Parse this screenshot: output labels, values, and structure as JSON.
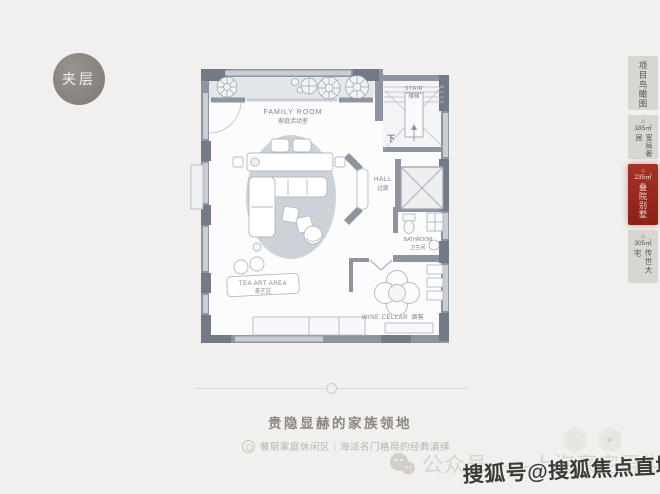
{
  "page": {
    "background": "#f1f0ee"
  },
  "badge": {
    "label": "夹层"
  },
  "floorplan": {
    "rooms": {
      "family": {
        "en": "FAMILY ROOM",
        "zh": "家庭活动室"
      },
      "stair": {
        "en": "STAIR",
        "zh": "楼梯",
        "direction": "下"
      },
      "hall": {
        "en": "HALL",
        "zh": "过廊"
      },
      "bathroom": {
        "en": "BATHROOM",
        "zh": "卫生间"
      },
      "tea": {
        "en": "TEA ART AREA",
        "zh": "茶艺区"
      },
      "wine": {
        "en": "WINE CELLAR",
        "zh": "酒窖"
      }
    }
  },
  "sidebar": {
    "items": [
      {
        "label": "项目鸟瞰图",
        "active": false
      },
      {
        "marker": "⌂",
        "area": "185㎡",
        "label": "宽局奢居",
        "active": false
      },
      {
        "marker": "⌂",
        "area": "235㎡",
        "label": "叠院别墅",
        "active": true
      },
      {
        "marker": "⌂",
        "area": "305㎡",
        "label": "传世大宅",
        "active": false
      }
    ],
    "active_color": "#9b2a20"
  },
  "footer": {
    "heading": "贵隐显赫的家族领地",
    "subtitle": "餐厨家庭休闲区｜海派名门格局的经典演绎"
  },
  "watermarks": {
    "wechat_account": "公众号——上海豪宅层世界",
    "sohu": "搜狐号@搜狐焦点直城站"
  },
  "icons": {
    "home": "⌂",
    "share": "➤"
  },
  "colors": {
    "accent_red": "#9b2a20",
    "badge_gray": "#8a857e",
    "wall_gray": "#8e94a0",
    "rug": "#cdd2d8"
  }
}
